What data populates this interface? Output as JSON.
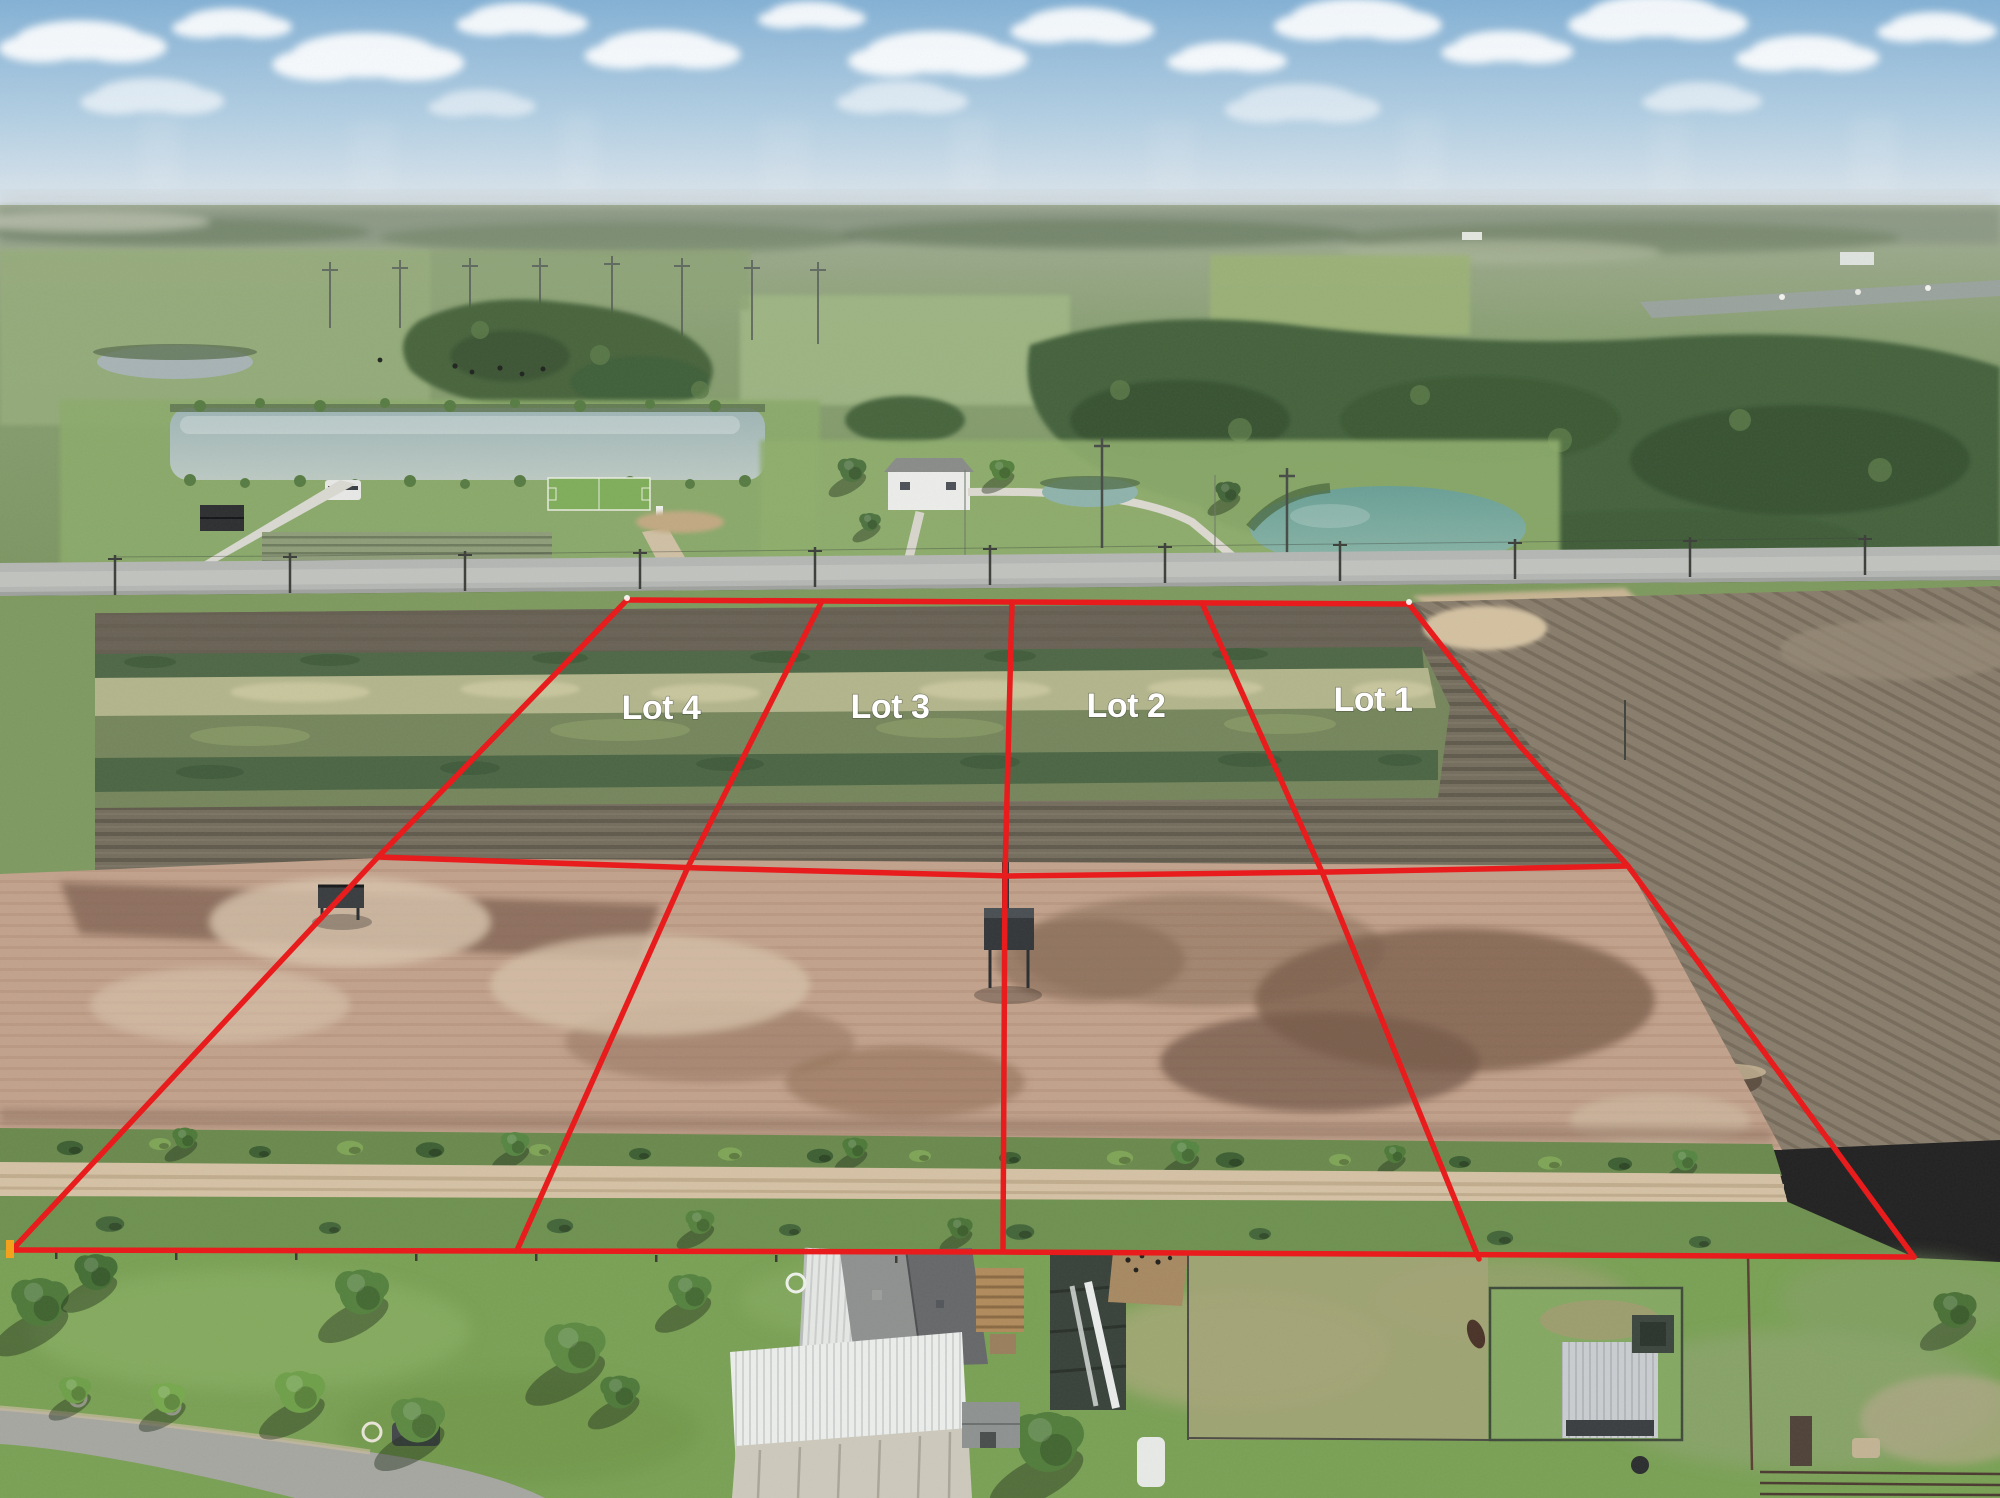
{
  "overlay": {
    "accent_color": "#e81c1c",
    "label_color": "#ffffff",
    "corner_marker_color": "#f2a21c",
    "lots": [
      {
        "label": "Lot 4"
      },
      {
        "label": "Lot 3"
      },
      {
        "label": "Lot 2"
      },
      {
        "label": "Lot 1"
      }
    ]
  },
  "photo": {
    "sky_color": "#9cbedb",
    "cloud_color": "#ffffff",
    "pasture_green": "#7ba155",
    "tilled_field_brown": "#756e5e",
    "mud_field_tan": "#c2a28c",
    "paved_road_gray": "#b4b7b3",
    "dirt_road_tan": "#d5c2a5",
    "pond_color": "#8fb3ac"
  }
}
